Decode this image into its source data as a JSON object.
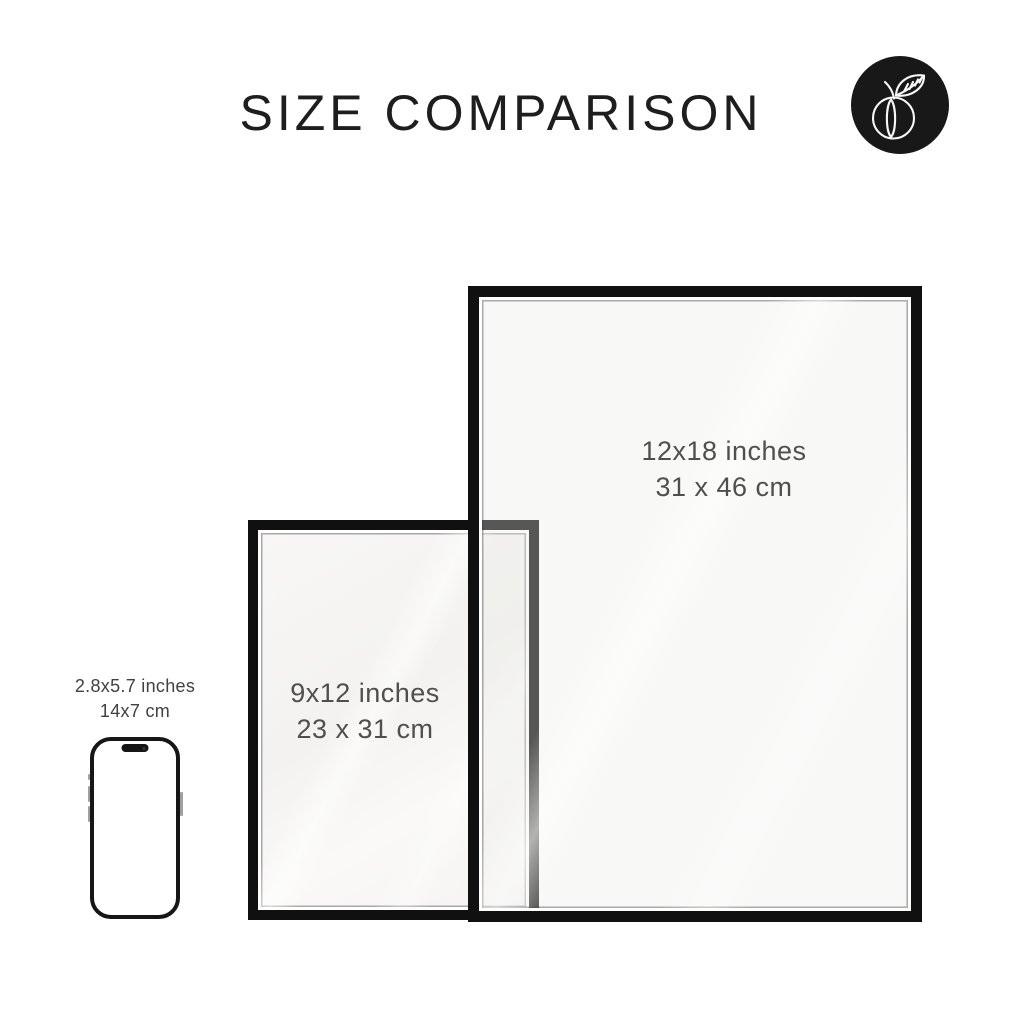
{
  "header": {
    "title": "SIZE COMPARISON"
  },
  "logo": {
    "icon": "peach-icon",
    "background_color": "#181818",
    "stroke_color": "#f7f7f7"
  },
  "frames": {
    "large": {
      "size_in": "12x18 inches",
      "size_cm": "31 x 46 cm"
    },
    "medium": {
      "size_in": "9x12 inches",
      "size_cm": "23 x 31 cm"
    }
  },
  "phone": {
    "size_in": "2.8x5.7 inches",
    "size_cm": "14x7 cm"
  },
  "colors": {
    "background": "#ffffff",
    "frame_border": "#101010",
    "label_text": "#4f4f4f",
    "title_text": "#1e1e1e"
  }
}
